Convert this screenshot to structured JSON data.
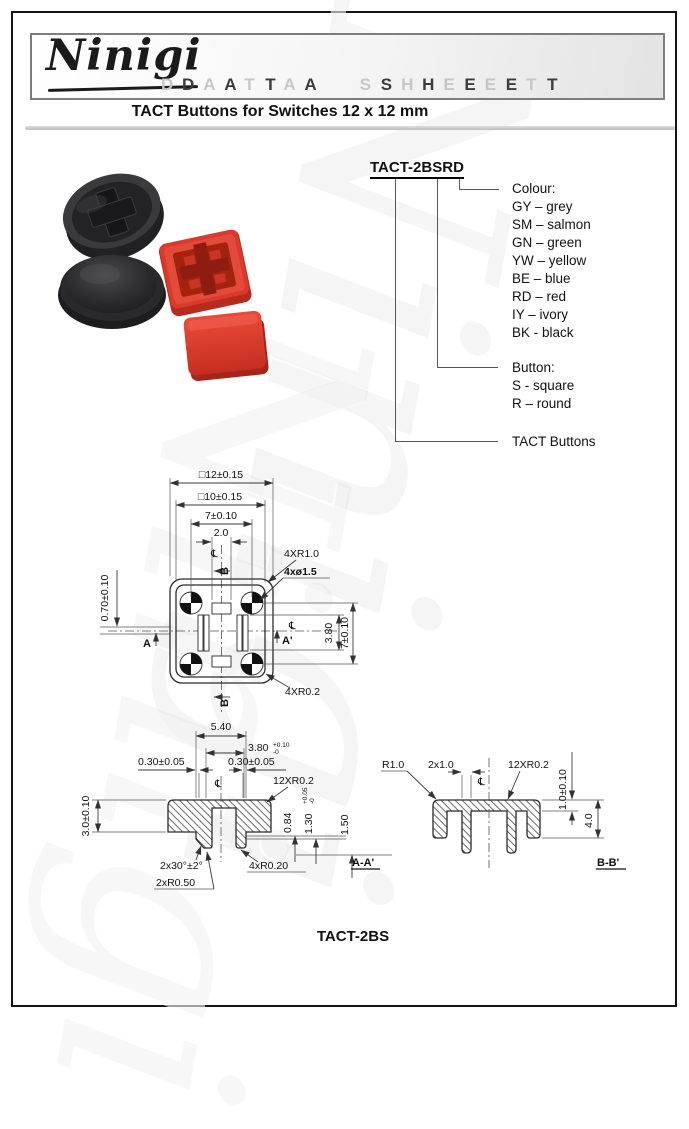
{
  "header": {
    "brand": "Ninigi",
    "datasheet": "DATA SHEET"
  },
  "decor": {
    "watermark": "Ninigi"
  },
  "title": "TACT Buttons for Switches 12 x 12 mm",
  "part_number": {
    "code_main": "TACT-2B",
    "code_button": "S",
    "code_colour": "RD",
    "colour_heading": "Colour:",
    "colours": [
      "GY – grey",
      "SM – salmon",
      "GN – green",
      "YW – yellow",
      "BE – blue",
      "RD – red",
      "IY – ivory",
      "BK - black"
    ],
    "button_heading": "Button:",
    "button_types": [
      "S - square",
      "R – round"
    ],
    "family": "TACT Buttons"
  },
  "symbols": {
    "centerline": "℄"
  },
  "top_view": {
    "dim_outer": "□12±0.15",
    "dim_inner": "□10±0.15",
    "dim_hole_spacing_h": "7±0.10",
    "dim_slot_width": "2.0",
    "dim_offset": "0.70±0.10",
    "callout_corner_radius": "4XR1.0",
    "callout_holes": "4xø1.5",
    "dim_slot_height": "3.80",
    "dim_hole_spacing_v": "7±0.10",
    "callout_small_radius": "4XR0.2",
    "marker_a": "A",
    "marker_a_prime": "A'",
    "marker_b_top": "B",
    "marker_b_bottom": "B"
  },
  "section_aa": {
    "dim_540": "5.40",
    "dim_380": "3.80",
    "tol_380_plus": "+0.10",
    "tol_380_minus": "-0",
    "dim_030_left": "0.30±0.05",
    "dim_030_right": "0.30±0.05",
    "dim_height": "3.0±0.10",
    "callout_r02": "12XR0.2",
    "dim_084": "0.84",
    "dim_130": "1.30",
    "tol_130_plus": "+0.05",
    "tol_130_minus": "-0",
    "dim_150": "1.50",
    "callout_chamfer": "2x30°±2°",
    "callout_r020": "4xR0.20",
    "callout_r050": "2xR0.50",
    "label": "A-A'"
  },
  "section_bb": {
    "callout_r10": "R1.0",
    "dim_2x10": "2x1.0",
    "callout_r02": "12XR0.2",
    "dim_flange": "1.0±0.10",
    "dim_height": "4.0",
    "label": "B-B'"
  },
  "footer": {
    "model": "TACT-2BS"
  }
}
